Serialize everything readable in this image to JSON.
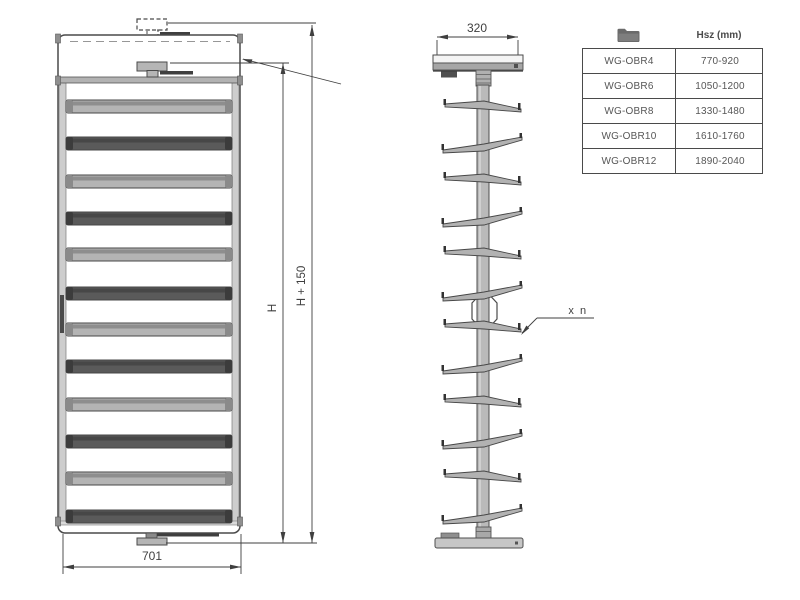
{
  "drawing": {
    "front_view": {
      "width_dim": "701",
      "height_dim": "H",
      "total_height_dim": "H + 150",
      "rung_count": 12
    },
    "side_view": {
      "depth_dim": "320",
      "repeat_label": "x n",
      "arm_count": 12
    }
  },
  "table": {
    "header": {
      "model_icon": "folder-icon",
      "hsz_label": "Hsz (mm)"
    },
    "rows": [
      {
        "model": "WG-OBR4",
        "hsz": "770-920"
      },
      {
        "model": "WG-OBR6",
        "hsz": "1050-1200"
      },
      {
        "model": "WG-OBR8",
        "hsz": "1330-1480"
      },
      {
        "model": "WG-OBR10",
        "hsz": "1610-1760"
      },
      {
        "model": "WG-OBR12",
        "hsz": "1890-2040"
      }
    ]
  },
  "colors": {
    "line": "#3f3f3f",
    "outline": "#474747",
    "rung_light": "#b4b4b4",
    "rung_dark": "#5a5a5a",
    "frame": "#cdcdcd",
    "background": "#ffffff"
  }
}
